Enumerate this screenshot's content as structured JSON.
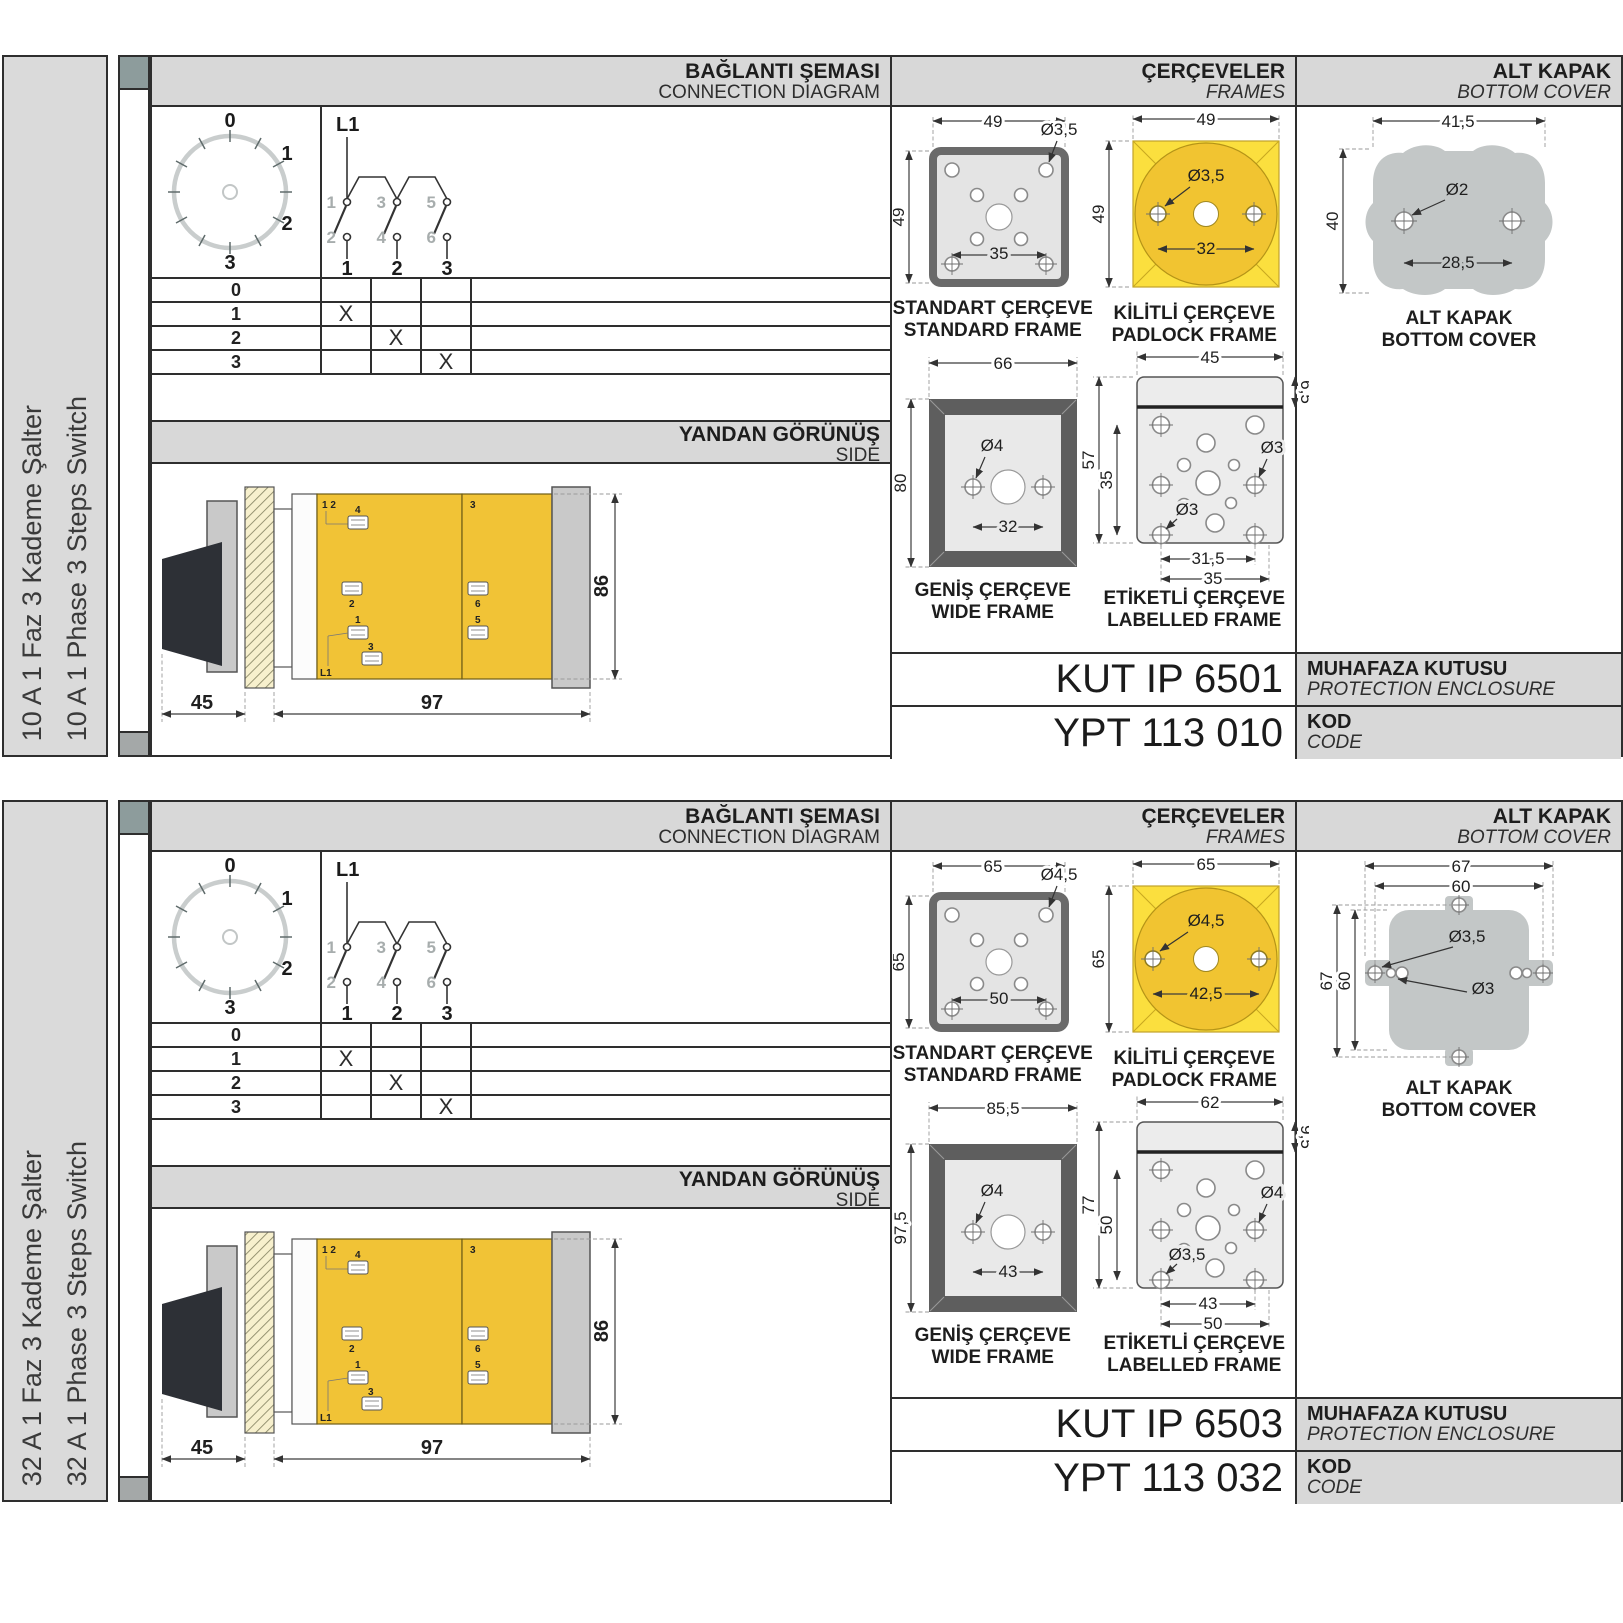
{
  "palette": {
    "frame_yellow": "#fbdf3e",
    "circle_yellow": "#f1c431",
    "body_yellow": "#f1c336",
    "band_gray": "#d8d8d8",
    "metal_gray": "#c3c7c7",
    "border_dark": "#2e2e2e"
  },
  "sections": [
    {
      "sidebar": {
        "title_tr": "10 A 1 Faz 3 Kademe Şalter",
        "title_en": "10 A 1 Phase 3 Steps Switch"
      },
      "headers": {
        "connection_tr": "BAĞLANTI ŞEMASI",
        "connection_en": "CONNECTION DIAGRAM",
        "frames_tr": "ÇERÇEVELER",
        "frames_en": "FRAMES",
        "cover_tr": "ALT KAPAK",
        "cover_en": "BOTTOM COVER"
      },
      "dial": {
        "p0": "0",
        "p1": "1",
        "p2": "2",
        "p3": "3"
      },
      "circuit": {
        "source": "L1",
        "poles": [
          {
            "top": "1",
            "bottom": "2",
            "col": "1"
          },
          {
            "top": "3",
            "bottom": "4",
            "col": "2"
          },
          {
            "top": "5",
            "bottom": "6",
            "col": "3"
          }
        ]
      },
      "table": {
        "rows": [
          {
            "label": "0",
            "m1": "",
            "m2": "",
            "m3": ""
          },
          {
            "label": "1",
            "m1": "X",
            "m2": "",
            "m3": ""
          },
          {
            "label": "2",
            "m1": "",
            "m2": "X",
            "m3": ""
          },
          {
            "label": "3",
            "m1": "",
            "m2": "",
            "m3": "X"
          }
        ]
      },
      "side_view": {
        "title_tr": "YANDAN GÖRÜNÜŞ",
        "title_en": "SIDE",
        "dim_front": "45",
        "dim_depth": "97",
        "dim_height": "86",
        "terminals": {
          "pair": "1 2",
          "top": "3",
          "t4": "4",
          "t2": "2",
          "t6": "6",
          "t1": "1",
          "t5": "5",
          "t3": "3",
          "l1": "L1"
        }
      },
      "frames": {
        "standard": {
          "label_tr": "STANDART ÇERÇEVE",
          "label_en": "STANDARD FRAME",
          "dim_w": "49",
          "dim_h": "49",
          "hole": "Ø3,5",
          "dim_inner": "35"
        },
        "padlock": {
          "label_tr": "KİLİTLİ ÇERÇEVE",
          "label_en": "PADLOCK FRAME",
          "dim_w": "49",
          "dim_h": "49",
          "hole": "Ø3,5",
          "dim_inner": "32"
        },
        "wide": {
          "label_tr": "GENİŞ ÇERÇEVE",
          "label_en": "WIDE FRAME",
          "dim_w": "66",
          "dim_h": "80",
          "hole": "Ø4",
          "dim_inner": "32"
        },
        "labelled": {
          "label_tr": "ETİKETLİ ÇERÇEVE",
          "label_en": "LABELLED FRAME",
          "dim_w": "45",
          "dim_band": "6,5",
          "dim_h": "57",
          "dim_inner_h": "35",
          "hole_right": "Ø3",
          "hole_bottom": "Ø3",
          "dim_inner_w": "31,5",
          "dim_outer_w": "35"
        }
      },
      "cover": {
        "label_tr": "ALT KAPAK",
        "label_en": "BOTTOM COVER",
        "dim_w": "41,5",
        "dim_h": "40",
        "hole": "Ø2",
        "dim_inner": "28,5"
      },
      "codes": {
        "enclosure_code": "KUT IP 6501",
        "enclosure_tr": "MUHAFAZA KUTUSU",
        "enclosure_en": "PROTECTION ENCLOSURE",
        "code": "YPT 113 010",
        "code_tr": "KOD",
        "code_en": "CODE"
      }
    },
    {
      "sidebar": {
        "title_tr": "32 A 1 Faz 3 Kademe Şalter",
        "title_en": "32 A 1 Phase 3 Steps Switch"
      },
      "headers": {
        "connection_tr": "BAĞLANTI ŞEMASI",
        "connection_en": "CONNECTION DIAGRAM",
        "frames_tr": "ÇERÇEVELER",
        "frames_en": "FRAMES",
        "cover_tr": "ALT KAPAK",
        "cover_en": "BOTTOM COVER"
      },
      "dial": {
        "p0": "0",
        "p1": "1",
        "p2": "2",
        "p3": "3"
      },
      "circuit": {
        "source": "L1",
        "poles": [
          {
            "top": "1",
            "bottom": "2",
            "col": "1"
          },
          {
            "top": "3",
            "bottom": "4",
            "col": "2"
          },
          {
            "top": "5",
            "bottom": "6",
            "col": "3"
          }
        ]
      },
      "table": {
        "rows": [
          {
            "label": "0",
            "m1": "",
            "m2": "",
            "m3": ""
          },
          {
            "label": "1",
            "m1": "X",
            "m2": "",
            "m3": ""
          },
          {
            "label": "2",
            "m1": "",
            "m2": "X",
            "m3": ""
          },
          {
            "label": "3",
            "m1": "",
            "m2": "",
            "m3": "X"
          }
        ]
      },
      "side_view": {
        "title_tr": "YANDAN GÖRÜNÜŞ",
        "title_en": "SIDE",
        "dim_front": "45",
        "dim_depth": "97",
        "dim_height": "86",
        "terminals": {
          "pair": "1 2",
          "top": "3",
          "t4": "4",
          "t2": "2",
          "t6": "6",
          "t1": "1",
          "t5": "5",
          "t3": "3",
          "l1": "L1"
        }
      },
      "frames": {
        "standard": {
          "label_tr": "STANDART ÇERÇEVE",
          "label_en": "STANDARD FRAME",
          "dim_w": "65",
          "dim_h": "65",
          "hole": "Ø4,5",
          "dim_inner": "50"
        },
        "padlock": {
          "label_tr": "KİLİTLİ ÇERÇEVE",
          "label_en": "PADLOCK FRAME",
          "dim_w": "65",
          "dim_h": "65",
          "hole": "Ø4,5",
          "dim_inner": "42,5"
        },
        "wide": {
          "label_tr": "GENİŞ ÇERÇEVE",
          "label_en": "WIDE FRAME",
          "dim_w": "85,5",
          "dim_h": "97,5",
          "hole": "Ø4",
          "dim_inner": "43"
        },
        "labelled": {
          "label_tr": "ETİKETLİ ÇERÇEVE",
          "label_en": "LABELLED FRAME",
          "dim_w": "62",
          "dim_band": "9,5",
          "dim_h": "77",
          "dim_inner_h": "50",
          "hole_right": "Ø4",
          "hole_bottom": "Ø3,5",
          "dim_inner_w": "43",
          "dim_outer_w": "50"
        }
      },
      "cover": {
        "label_tr": "ALT KAPAK",
        "label_en": "BOTTOM COVER",
        "dim_w": "67",
        "dim_w_inner": "60",
        "dim_h": "67",
        "dim_h_inner": "60",
        "hole1": "Ø3,5",
        "hole2": "Ø3"
      },
      "codes": {
        "enclosure_code": "KUT IP 6503",
        "enclosure_tr": "MUHAFAZA KUTUSU",
        "enclosure_en": "PROTECTION ENCLOSURE",
        "code": "YPT 113 032",
        "code_tr": "KOD",
        "code_en": "CODE"
      }
    }
  ]
}
